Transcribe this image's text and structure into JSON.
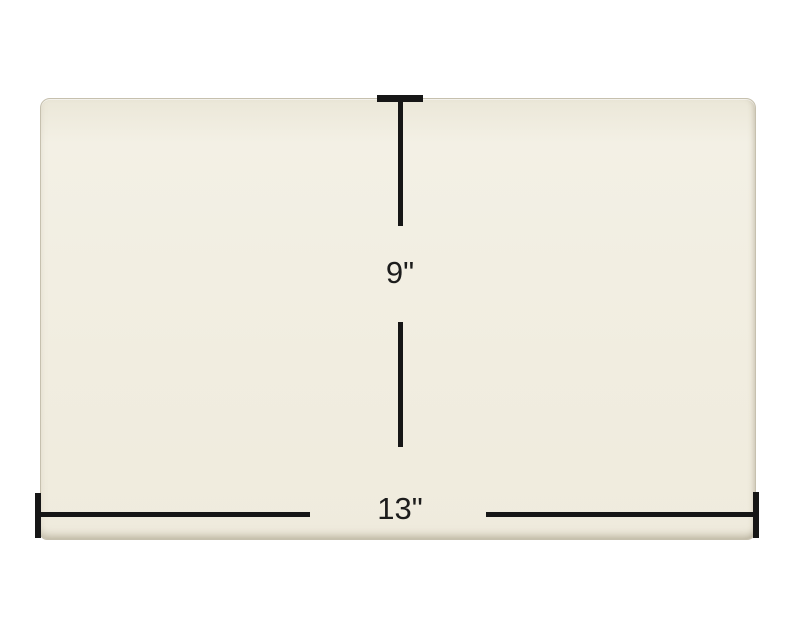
{
  "dimensions": {
    "height": {
      "label": "9\""
    },
    "width": {
      "label": "13\""
    }
  },
  "colors": {
    "background": "#ffffff",
    "panel_fill": "#f1ede0",
    "panel_edge": "#c6c0ae",
    "dimension_line": "#161616",
    "label_text": "#1c1c1c"
  }
}
